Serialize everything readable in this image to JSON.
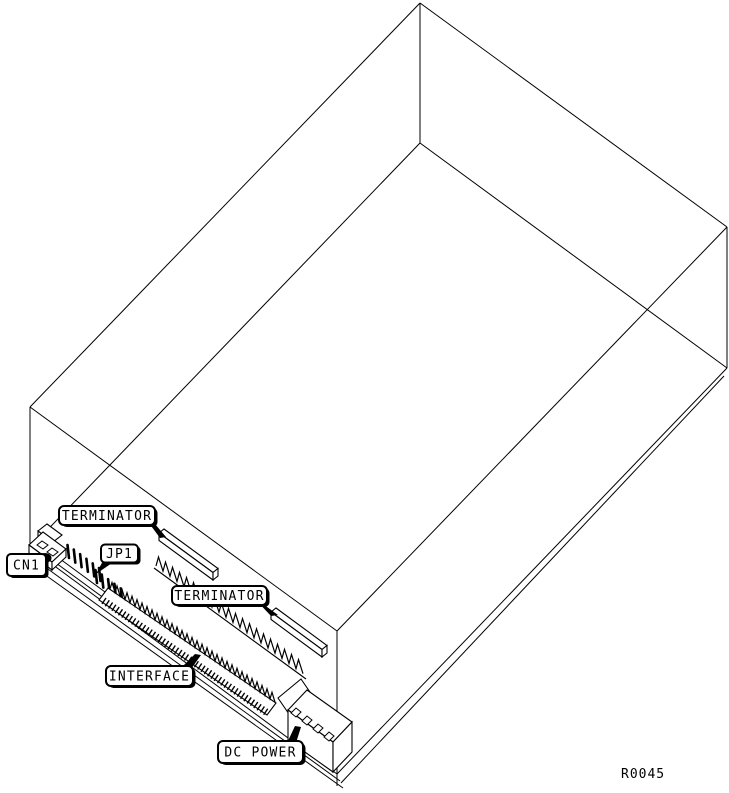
{
  "figure": {
    "ref": "R0045"
  },
  "callouts": {
    "terminator_top": {
      "label": "TERMINATOR"
    },
    "jp1": {
      "label": "JP1"
    },
    "cn1": {
      "label": "CN1"
    },
    "terminator_mid": {
      "label": "TERMINATOR"
    },
    "interface": {
      "label": "INTERFACE"
    },
    "dc_power": {
      "label": "DC POWER"
    }
  },
  "colors": {
    "line": "#000000",
    "background": "#ffffff"
  }
}
